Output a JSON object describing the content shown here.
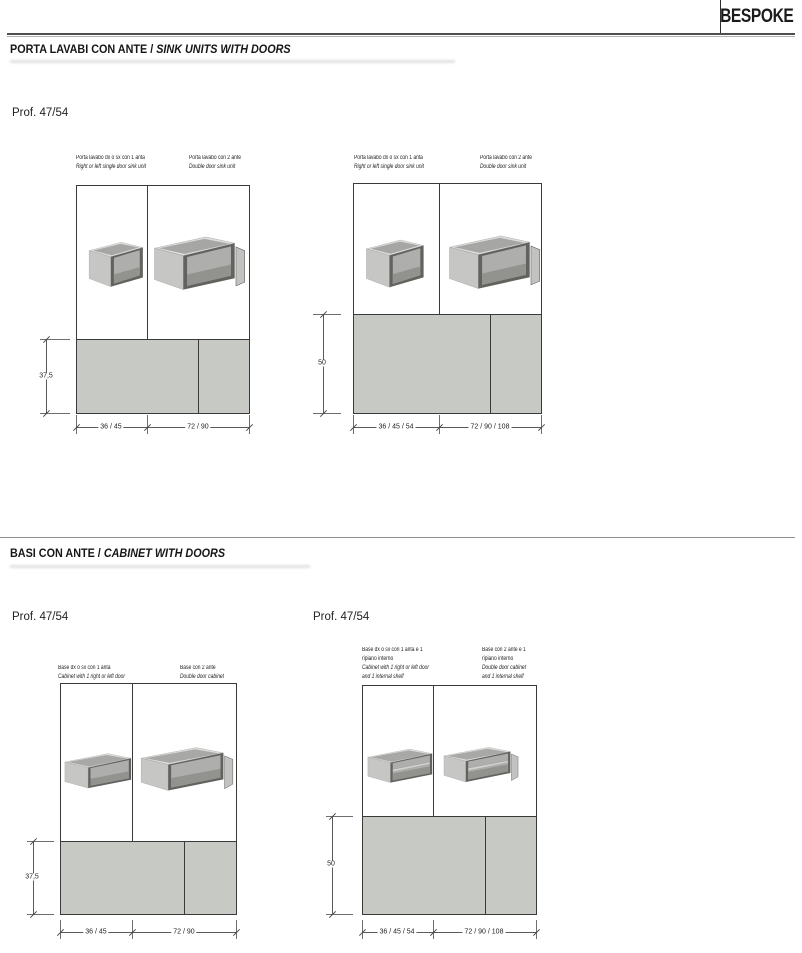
{
  "brand": "BESPOKE",
  "colors": {
    "panel_gray": "#c7c9c5",
    "frame_line": "#3a3a3a",
    "dim_line": "#5a5a5a"
  },
  "section1": {
    "title_it": "PORTA LAVABI CON ANTE",
    "title_sep": " / ",
    "title_en": "SINK UNITS WITH DOORS",
    "profile": "Prof. 47/54"
  },
  "section2": {
    "title_it": "BASI CON ANTE",
    "title_sep": " / ",
    "title_en": "CABINET WITH DOORS",
    "profile_left": "Prof. 47/54",
    "profile_right": "Prof. 47/54"
  },
  "group1": {
    "height": "37,5",
    "col1": {
      "label_it": "Porta lavabo dx o sx con 1 anta",
      "label_en": "Right or left single door sink unit",
      "width": "36 / 45"
    },
    "col2": {
      "label_it": "Porta lavabo con 2 ante",
      "label_en": "Double door sink unit",
      "width": "72 / 90"
    }
  },
  "group2": {
    "height": "50",
    "col1": {
      "label_it": "Porta lavabo dx o sx con 1 anta",
      "label_en": "Right or left single door sink unit",
      "width": "36 / 45 / 54"
    },
    "col2": {
      "label_it": "Porta lavabo con 2 ante",
      "label_en": "Double door sink unit",
      "width": "72 / 90 / 108"
    }
  },
  "group3": {
    "height": "37,5",
    "col1": {
      "label_it": "Base dx o sx con 1 anta",
      "label_en": "Cabinet with 1 right or left door",
      "width": "36 / 45"
    },
    "col2": {
      "label_it": "Base con 2 ante",
      "label_en": "Double door cabinet",
      "width": "72 / 90"
    }
  },
  "group4": {
    "height": "50",
    "col1": {
      "label_it_1": "Base dx o sx con 1 anta e 1",
      "label_it_2": "ripiano interno",
      "label_en_1": "Cabinet with 1 right or left door",
      "label_en_2": "and 1 internal shelf",
      "width": "36 / 45 / 54"
    },
    "col2": {
      "label_it_1": "Base con 2 ante e 1",
      "label_it_2": "ripiano interno",
      "label_en_1": "Double door cabinet",
      "label_en_2": "and 1 internal shelf",
      "width": "72 / 90 / 108"
    }
  }
}
